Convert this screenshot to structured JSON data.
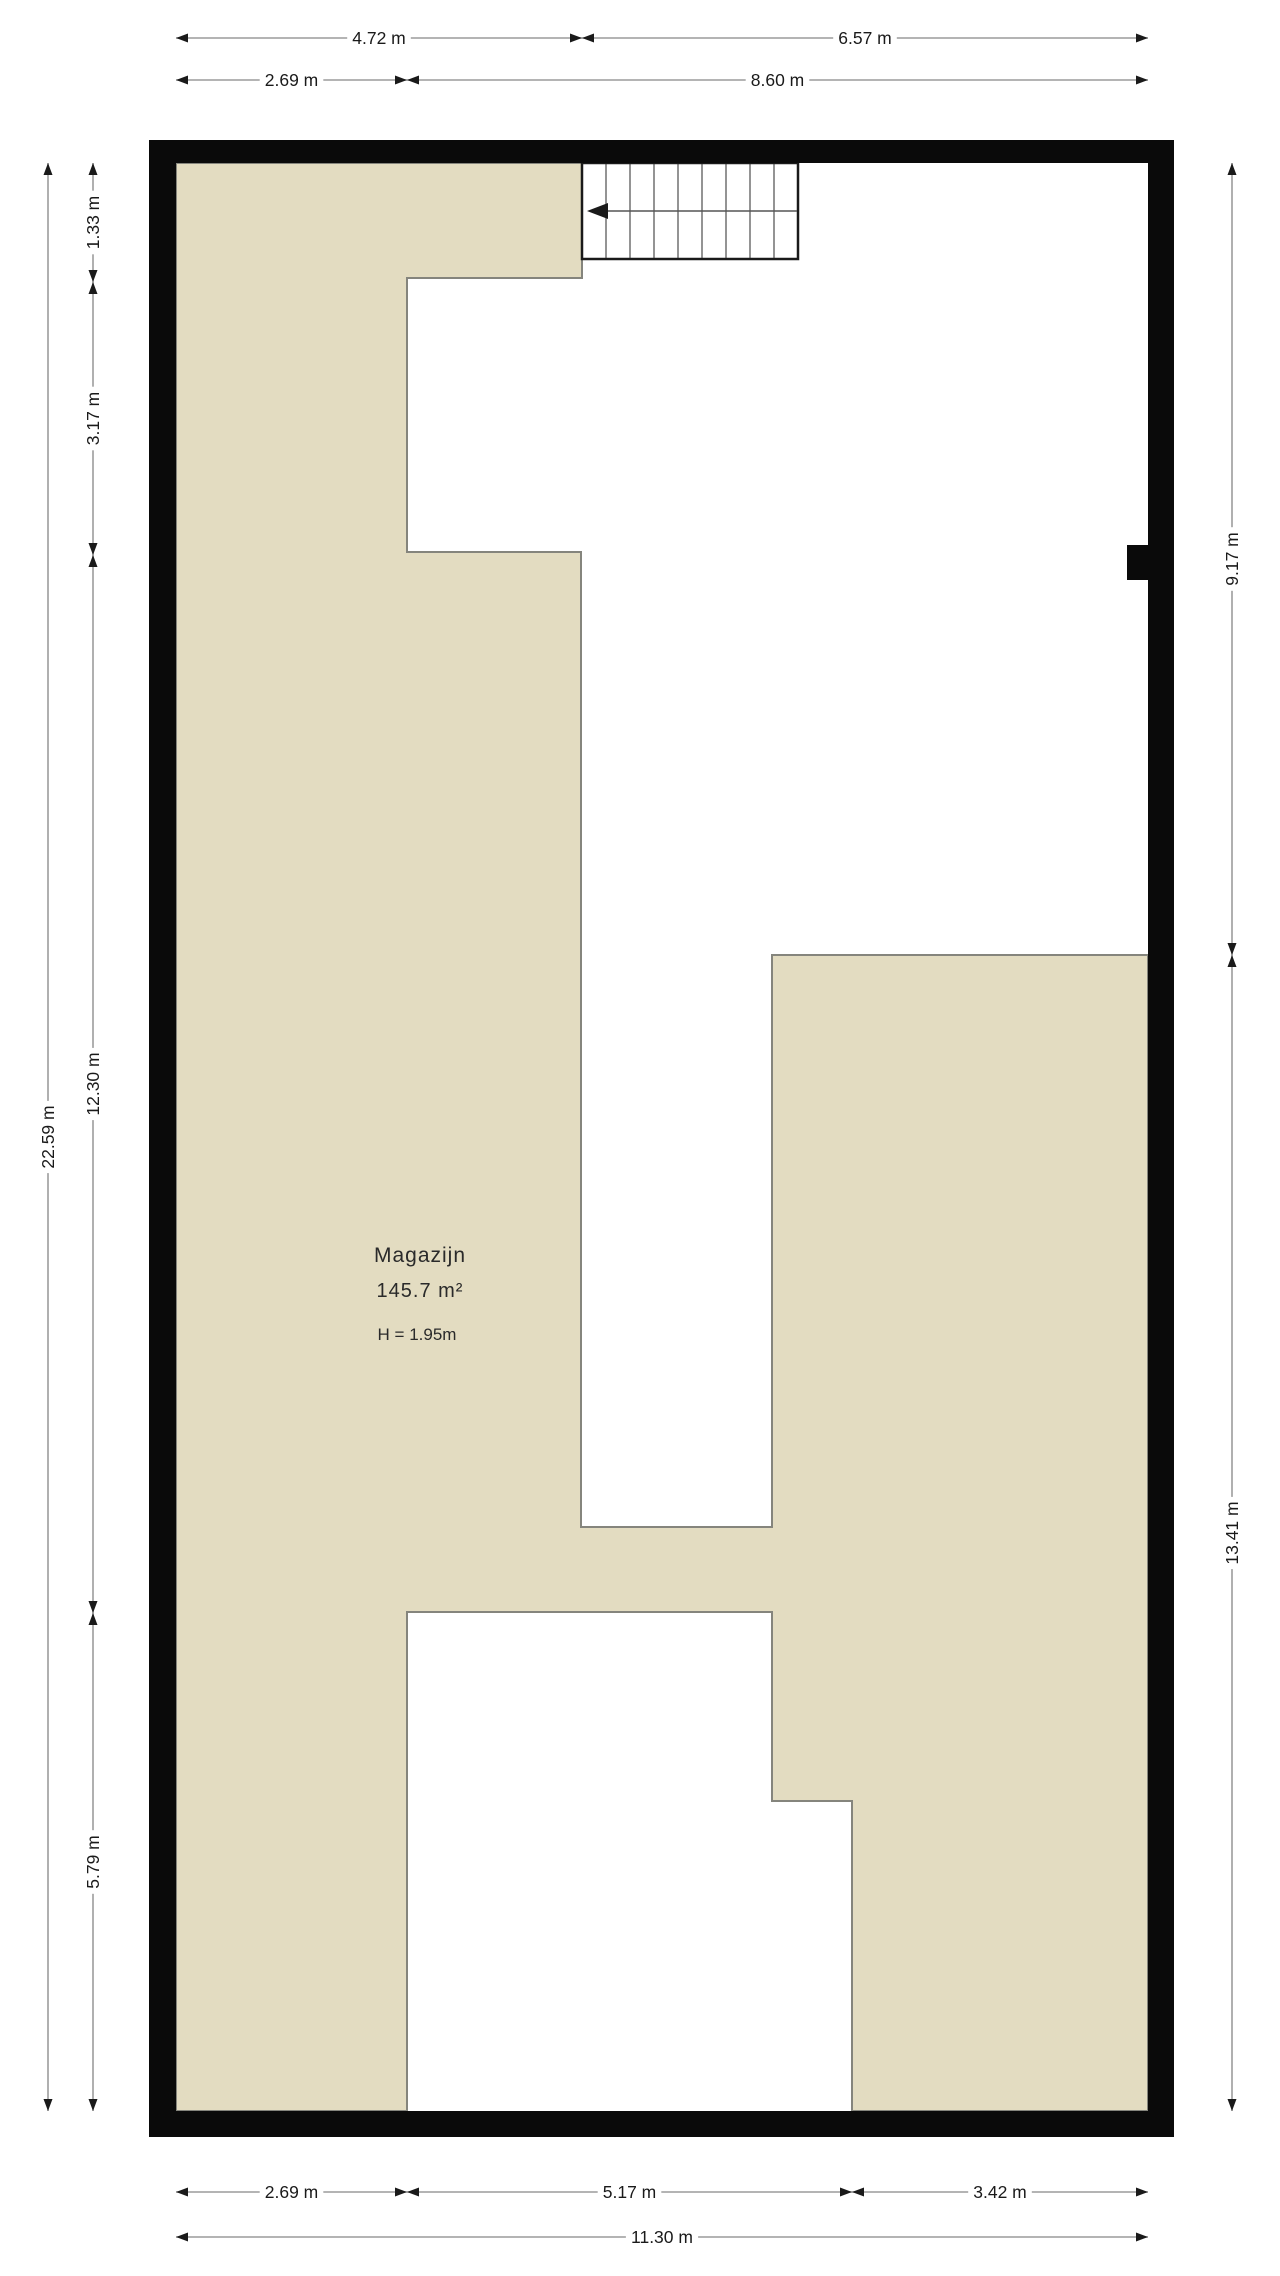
{
  "room": {
    "name": "Magazijn",
    "area": "145.7 m²",
    "height": "H = 1.95m"
  },
  "colors": {
    "floor_fill": "#E3DCC1",
    "boundary_line": "#85857D",
    "wall": "#0A0A0A",
    "dim_line": "#9C9C9C",
    "dim_text": "#1A1A1A",
    "stair_line": "#2A2A2A",
    "background": "#FFFFFF"
  },
  "icons": {
    "stair_direction": "stair-direction-arrow-icon"
  },
  "dimensions": [
    {
      "label": "4.72 m",
      "orient": "h",
      "fixed": 38,
      "from": 176,
      "to": 582
    },
    {
      "label": "6.57 m",
      "orient": "h",
      "fixed": 38,
      "from": 582,
      "to": 1148
    },
    {
      "label": "2.69 m",
      "orient": "h",
      "fixed": 80,
      "from": 176,
      "to": 407
    },
    {
      "label": "8.60 m",
      "orient": "h",
      "fixed": 80,
      "from": 407,
      "to": 1148
    },
    {
      "label": "2.69 m",
      "orient": "h",
      "fixed": 2192,
      "from": 176,
      "to": 407
    },
    {
      "label": "5.17 m",
      "orient": "h",
      "fixed": 2192,
      "from": 407,
      "to": 852
    },
    {
      "label": "3.42 m",
      "orient": "h",
      "fixed": 2192,
      "from": 852,
      "to": 1148
    },
    {
      "label": "11.30 m",
      "orient": "h",
      "fixed": 2237,
      "from": 176,
      "to": 1148
    },
    {
      "label": "22.59 m",
      "orient": "v",
      "fixed": 48,
      "from": 163,
      "to": 2111
    },
    {
      "label": "1.33 m",
      "orient": "v",
      "fixed": 93,
      "from": 163,
      "to": 282
    },
    {
      "label": "3.17 m",
      "orient": "v",
      "fixed": 93,
      "from": 282,
      "to": 555
    },
    {
      "label": "12.30 m",
      "orient": "v",
      "fixed": 93,
      "from": 555,
      "to": 1613
    },
    {
      "label": "5.79 m",
      "orient": "v",
      "fixed": 93,
      "from": 1613,
      "to": 2111
    },
    {
      "label": "9.17 m",
      "orient": "v",
      "fixed": 1232,
      "from": 163,
      "to": 955
    },
    {
      "label": "13.41 m",
      "orient": "v",
      "fixed": 1232,
      "from": 955,
      "to": 2111
    }
  ]
}
